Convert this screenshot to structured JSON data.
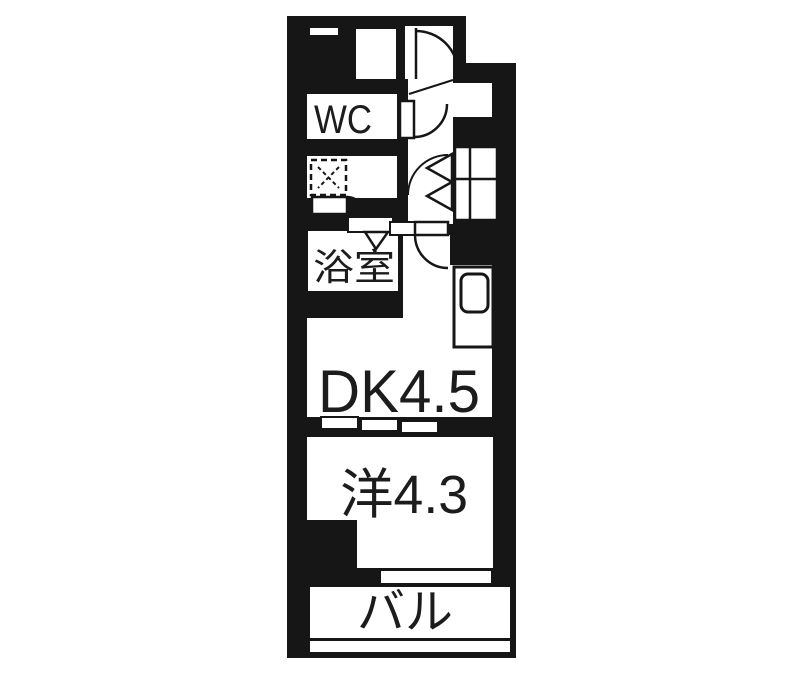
{
  "floorplan": {
    "rooms": {
      "wc": {
        "label": "WC"
      },
      "bathroom": {
        "label": "浴室"
      },
      "dining_kitchen": {
        "label": "DK4.5"
      },
      "western_room": {
        "label": "洋4.3"
      },
      "balcony": {
        "label": "バル"
      }
    },
    "colors": {
      "wall": "#161616",
      "floor": "#ffffff",
      "text": "#1c1c1c"
    }
  }
}
